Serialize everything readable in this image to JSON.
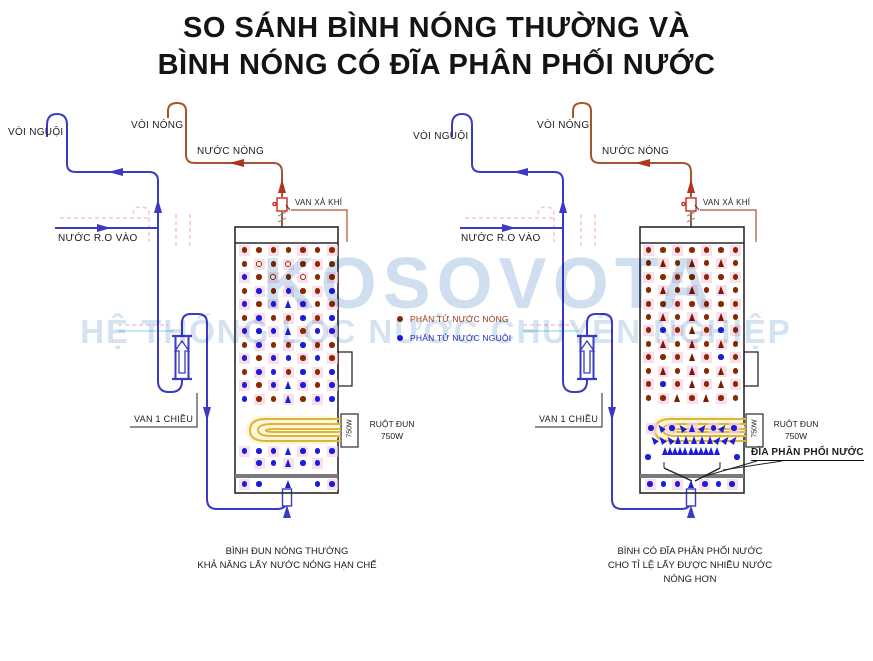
{
  "title": {
    "line1": "SO SÁNH BÌNH NÓNG THƯỜNG VÀ",
    "line2": "BÌNH NÓNG CÓ ĐĨA PHÂN PHỐI NƯỚC"
  },
  "watermark": {
    "line1": "KOSOVOTA",
    "line2": "HỆ THỐNG LỌC NƯỚC CHUYÊN NGHIỆP"
  },
  "colors": {
    "cold_pipe": "#3a3ac4",
    "hot_pipe": "#a8552e",
    "hot_dot": "#8c2800",
    "cold_dot": "#1c1cdc",
    "coil": "#dcb63c",
    "air_valve_red": "#d02818",
    "watermark_blue": "#9fc0e0",
    "pink_artifact": "#f6c3dc"
  },
  "legend": {
    "items": [
      {
        "label": "PHÂN TỬ NƯỚC NÓNG",
        "color": "#8c2800",
        "text_color": "#a03616"
      },
      {
        "label": "PHÂN TỬ NƯỚC NGUỘI",
        "color": "#1c1cdc",
        "text_color": "#2a2ac0"
      }
    ]
  },
  "diagrams": {
    "left": {
      "labels": {
        "cold_tap": "VÒI NGUỘI",
        "hot_tap": "VÒI NÓNG",
        "hot_water": "NƯỚC NÓNG",
        "ro_in": "NƯỚC R.O VÀO",
        "air_valve": "VAN XẢ KHÍ",
        "check_valve": "VAN 1 CHIỀU",
        "heater": "RUỘT ĐUN",
        "heater_power": "750W",
        "heater_power_rotated": "750W"
      },
      "caption": {
        "line1": "BÌNH ĐUN NÓNG THƯỜNG",
        "line2": "KHẢ NĂNG LẤY NƯỚC NÓNG HẠN CHẾ"
      }
    },
    "right": {
      "labels": {
        "cold_tap": "VÒI NGUỘI",
        "hot_tap": "VÒI NÓNG",
        "hot_water": "NƯỚC NÓNG",
        "ro_in": "NƯỚC R.O VÀO",
        "air_valve": "VAN XẢ KHÍ",
        "check_valve": "VAN 1 CHIỀU",
        "heater": "RUỘT ĐUN",
        "heater_power": "750W",
        "heater_power_rotated": "750W",
        "distribution_disc": "ĐĨA PHÂN PHỐI NƯỚC"
      },
      "caption": {
        "line1": "BÌNH CÓ ĐĨA PHÂN PHỐI NƯỚC",
        "line2": "CHO TỈ LỆ LẤY ĐƯỢC NHIỀU NƯỚC NÓNG HƠN"
      }
    }
  },
  "tanks": {
    "left": {
      "x0": 244.5,
      "gap": 14.6,
      "rows": [
        {
          "y": 250,
          "cells": "RRRRRRR"
        },
        {
          "y": 264,
          "cells": "RORORRR"
        },
        {
          "y": 277,
          "cells": "BRORORR"
        },
        {
          "y": 291,
          "cells": "RBRBRRB"
        },
        {
          "y": 304,
          "cells": "BRBABRR"
        },
        {
          "y": 318,
          "cells": "RBRRBRB"
        },
        {
          "y": 331,
          "cells": "BBBARBB"
        },
        {
          "y": 345,
          "cells": "RBRRBRR"
        },
        {
          "y": 358,
          "cells": "BRBBRBR"
        },
        {
          "y": 372,
          "cells": "RBBRBRB"
        },
        {
          "y": 385,
          "cells": "BRBABRB"
        },
        {
          "y": 399,
          "cells": "BRRARBB"
        },
        {
          "y": 451,
          "cells": "BBBABBB"
        },
        {
          "y": 463,
          "cells": ".BBABB."
        },
        {
          "y": 484,
          "cells": "BB.A.BB"
        }
      ]
    },
    "right": {
      "x0": 648.5,
      "gap": 14.5,
      "rows": [
        {
          "y": 250,
          "cells": "RRRRRRR"
        },
        {
          "y": 263,
          "cells": "RHRHRHR"
        },
        {
          "y": 277,
          "cells": "RRRRRRR"
        },
        {
          "y": 290,
          "cells": "RHRHRHR"
        },
        {
          "y": 304,
          "cells": "RRRRRRR"
        },
        {
          "y": 317,
          "cells": "RHRHRHR"
        },
        {
          "y": 330,
          "cells": "RBRHRBR"
        },
        {
          "y": 344,
          "cells": "RHRHRHR"
        },
        {
          "y": 357,
          "cells": "RRRHRBR"
        },
        {
          "y": 371,
          "cells": "RHRHRHR"
        },
        {
          "y": 384,
          "cells": "RBRHRHR"
        },
        {
          "y": 398,
          "cells": "RRHRHRR"
        },
        {
          "y": 428,
          "x0": 651,
          "gap": 10.4,
          "cells": "B<B<A>B>B"
        },
        {
          "y": 440,
          "x0": 654,
          "gap": 8.0,
          "cells": "<<<AAAAA>>>",
          "pink": false
        },
        {
          "y": 451,
          "x0": 665,
          "gap": 5.2,
          "cells": "AAAAAAAAAAA",
          "pink": false
        },
        {
          "y": 457,
          "x0": 648,
          "gap": 89,
          "cells": "BB",
          "pink": false
        },
        {
          "y": 484,
          "x0": 650,
          "gap": 13.7,
          "cells": "BBBABBB"
        }
      ]
    }
  }
}
